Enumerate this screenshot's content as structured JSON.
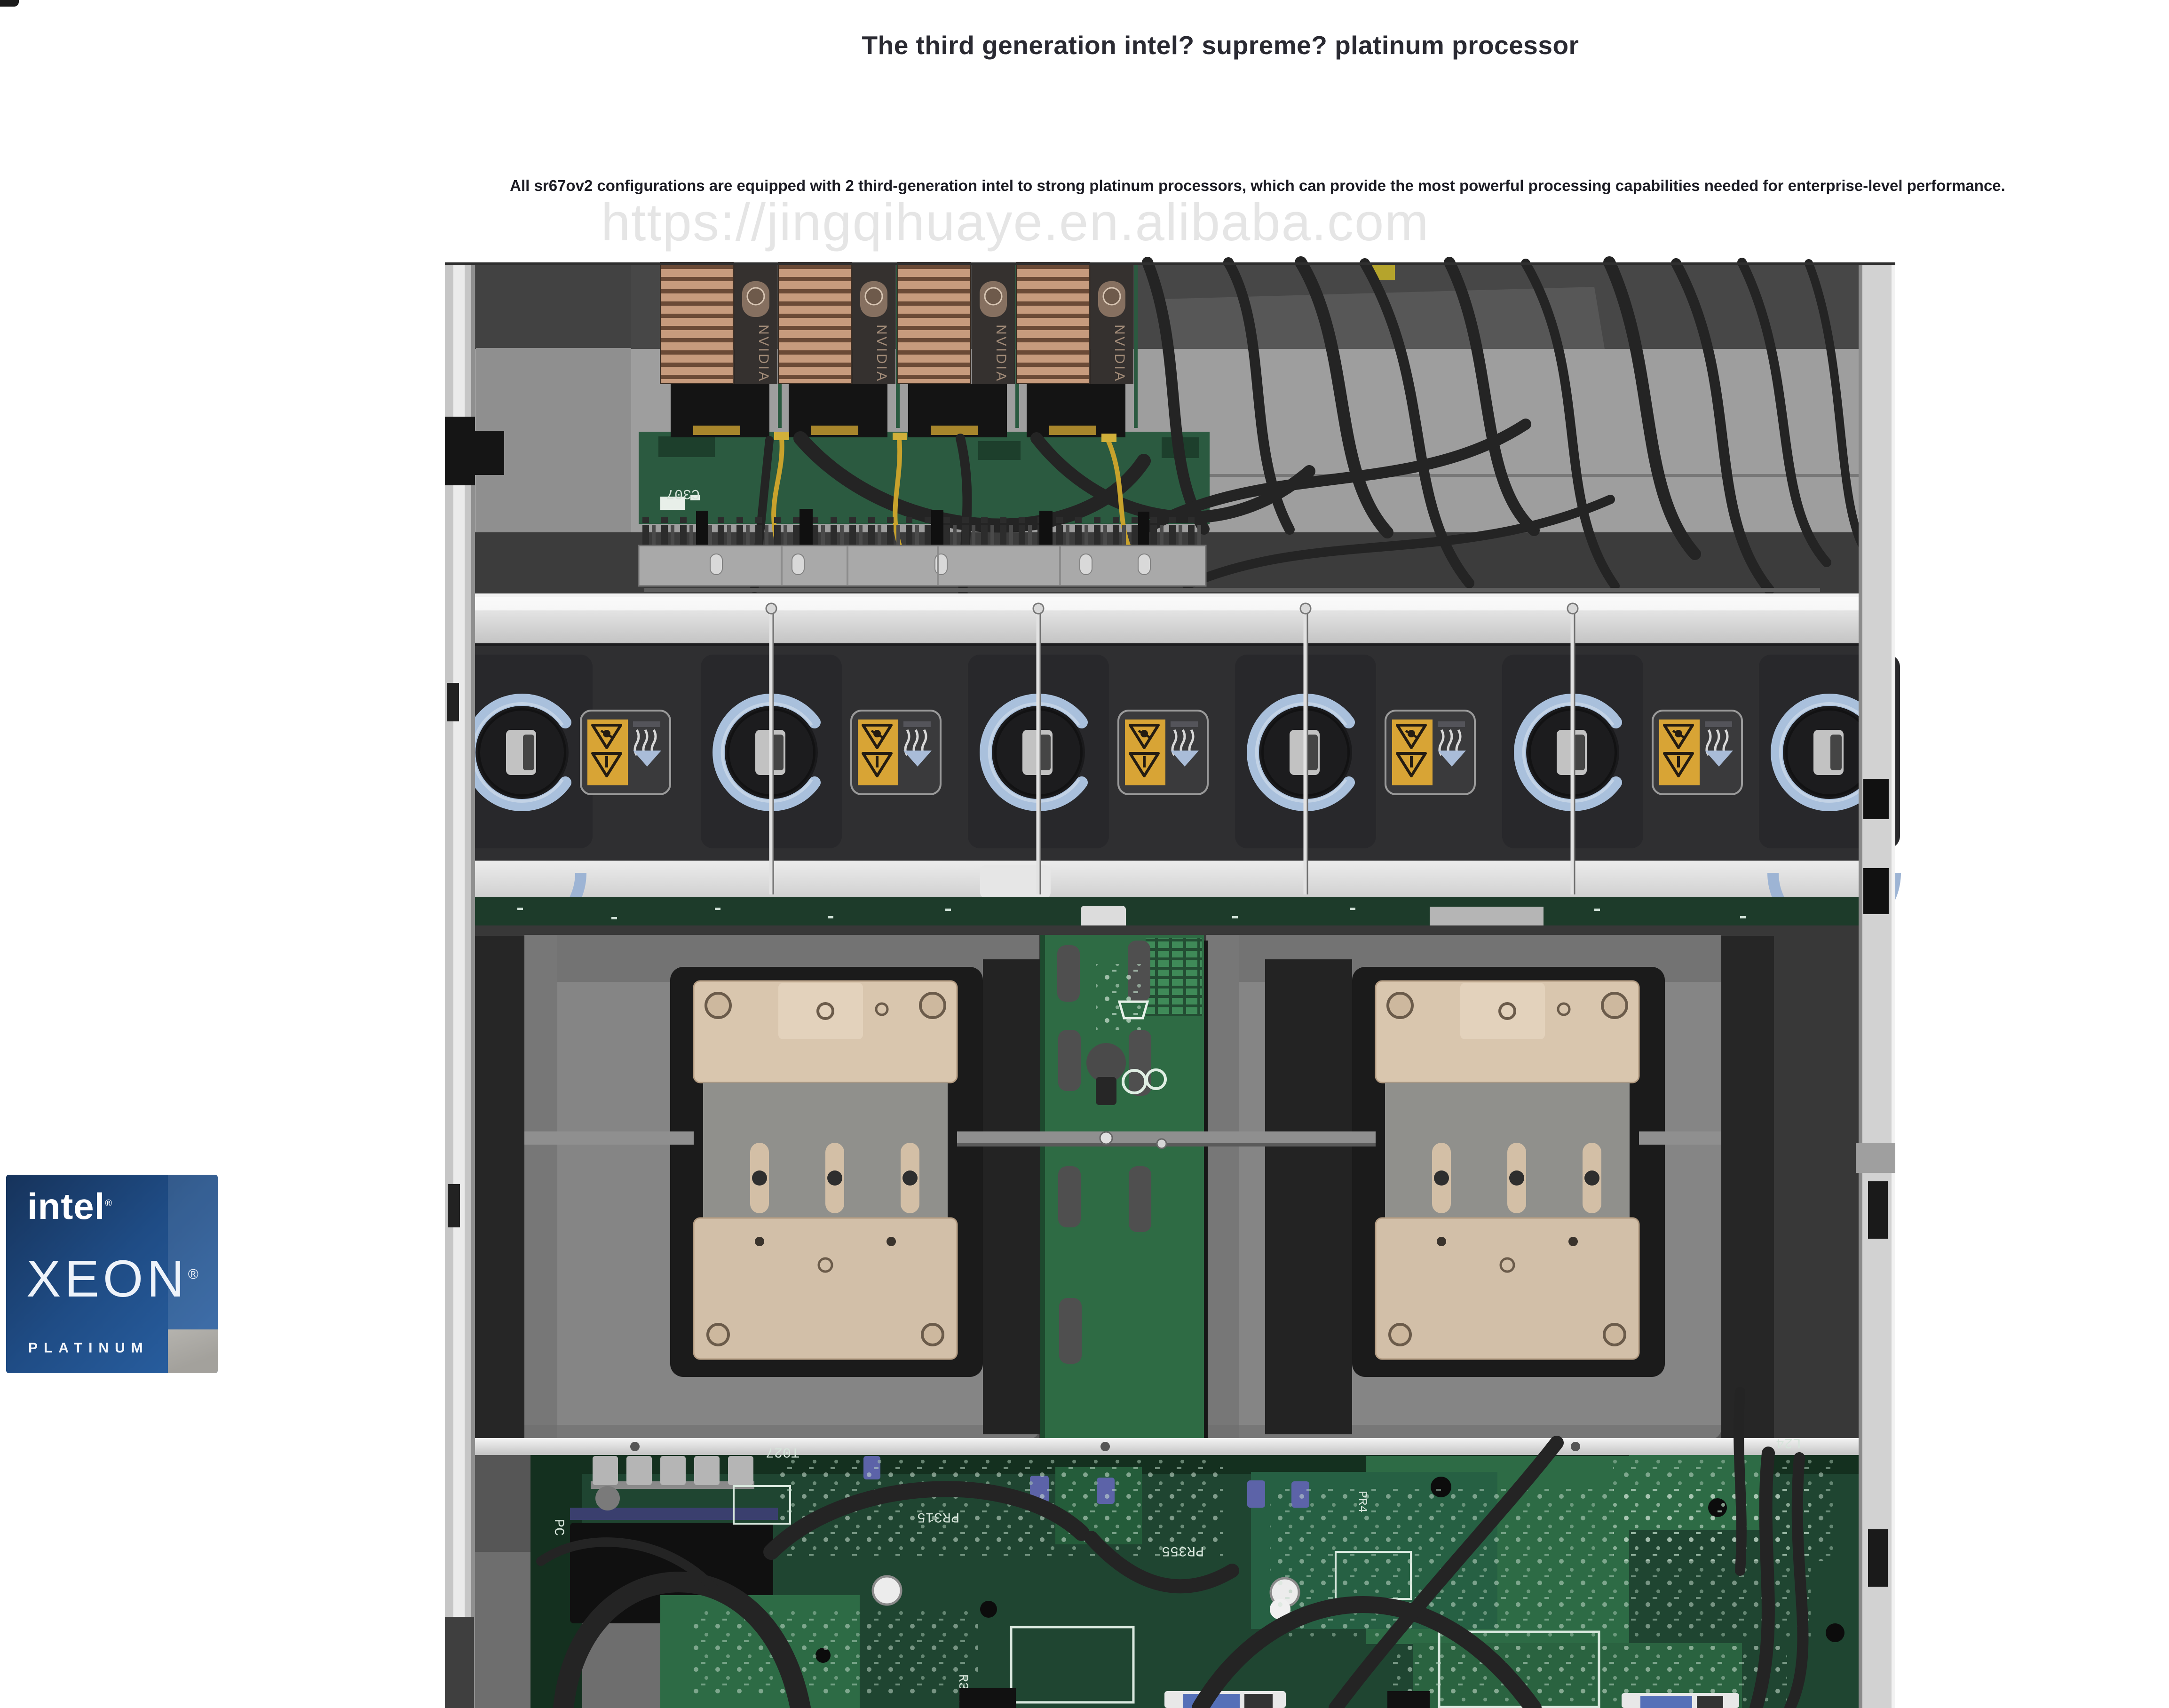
{
  "page": {
    "background": "#ffffff",
    "title": "The third generation intel? supreme? platinum processor",
    "description": "All sr67ov2 configurations are equipped with 2 third-generation intel to strong platinum processors, which can provide the most powerful processing capabilities needed for enterprise-level performance.",
    "watermark": "https://jingqihuaye.en.alibaba.com"
  },
  "badge": {
    "brand": "intel",
    "brand_mark": "®",
    "product": "XEON",
    "product_mark": "®",
    "tier": "PLATINUM",
    "colors": {
      "badge-blue-dark": "#16335b",
      "badge-blue": "#2a62a5",
      "badge-gray": "#a3a19c"
    }
  },
  "photo": {
    "gpu_label": "NVIDIA",
    "gpu_count": 4,
    "fan_count": 6,
    "fan_rod_count": 4,
    "warning_label_count": 5,
    "silkscreen": {
      "c307": "C307",
      "t027": "T027",
      "pr315": "PR315",
      "pr355": "PR355",
      "r359": "R359",
      "l24": "L24",
      "pr4": "PR4",
      "pc": "PC"
    },
    "palette": {
      "chassis": "#c6c6c6",
      "interior-dark": "#474747",
      "interior-light": "#9e9e9e",
      "copper": "#c79b7d",
      "copper-dark": "#6b4a36",
      "gpu-panel": "#35312f",
      "pcb-dark": "#1d3b2a",
      "pcb": "#1f4531",
      "pcb-bright": "#2d6b45",
      "fan-band": "#2f2f31",
      "fan-ring": "#a9c0dc",
      "amber": "#d8a435",
      "heatsink-tan": "#d9c6ae",
      "cable": "#242424",
      "silver": "#e2e2e2",
      "shroud": "#858585",
      "baffle": "#262626",
      "wire-yellow": "#c8a22c"
    }
  }
}
